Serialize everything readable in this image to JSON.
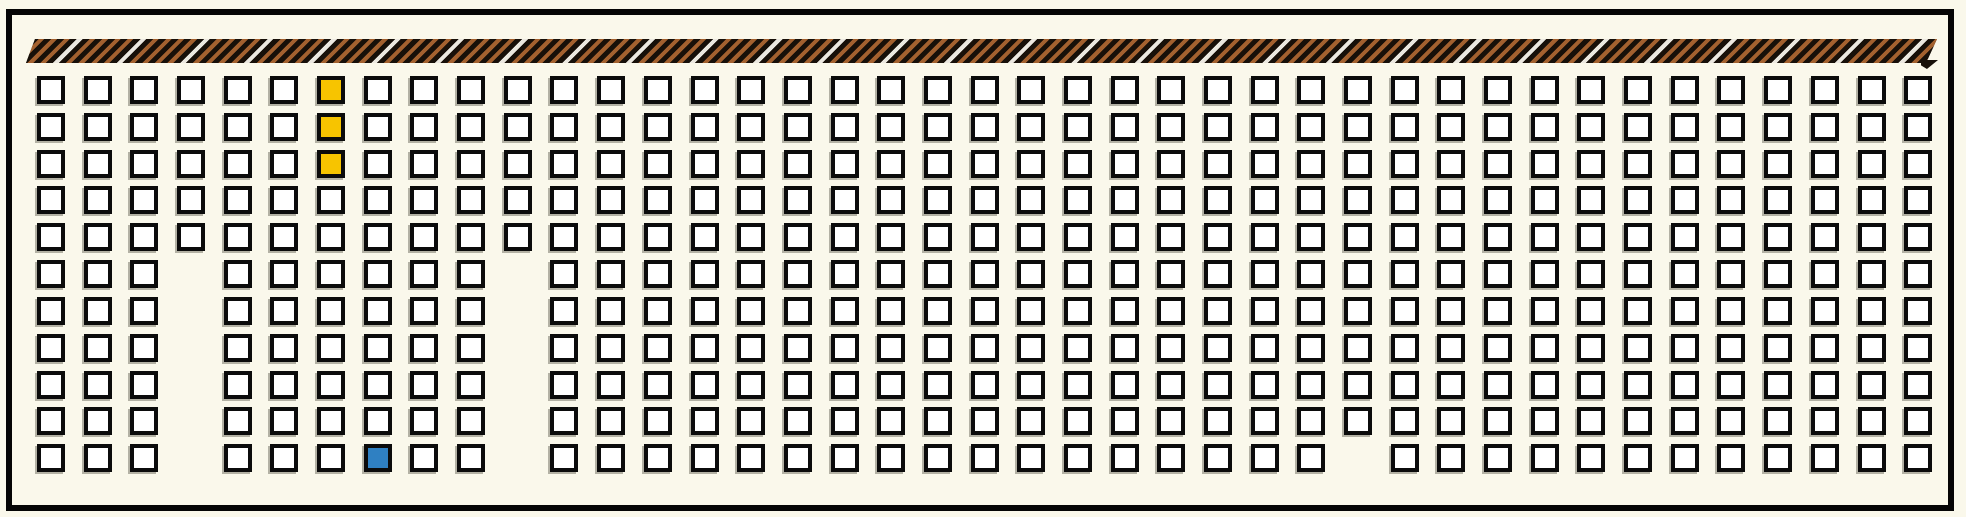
{
  "figure": {
    "description": "Seating-plan style grid diagram with a striped ribbon band across the top",
    "background_color": "#faf8eb",
    "frame_color": "#050505"
  },
  "ribbon": {
    "base_color": "#171009",
    "stripe_color_primary": "#a3612f",
    "stripe_color_accent": "#ebe8e0"
  },
  "grid": {
    "rows": 11,
    "cols": 41,
    "cell_fill_color": "#ffffff",
    "cell_border_color": "#0b0b0b",
    "missing_cells_by_row": {
      "5": [
        3,
        10
      ],
      "6": [
        3,
        10
      ],
      "7": [
        3,
        10
      ],
      "8": [
        3,
        10
      ],
      "9": [
        3,
        10
      ],
      "10": [
        3,
        10,
        28
      ]
    },
    "highlighted_cells": [
      {
        "row": 0,
        "col": 6,
        "color": "#f7c400",
        "name": "yellow"
      },
      {
        "row": 1,
        "col": 6,
        "color": "#f7c400",
        "name": "yellow"
      },
      {
        "row": 2,
        "col": 6,
        "color": "#f7c400",
        "name": "yellow"
      },
      {
        "row": 10,
        "col": 7,
        "color": "#2f80c2",
        "name": "blue"
      }
    ]
  }
}
